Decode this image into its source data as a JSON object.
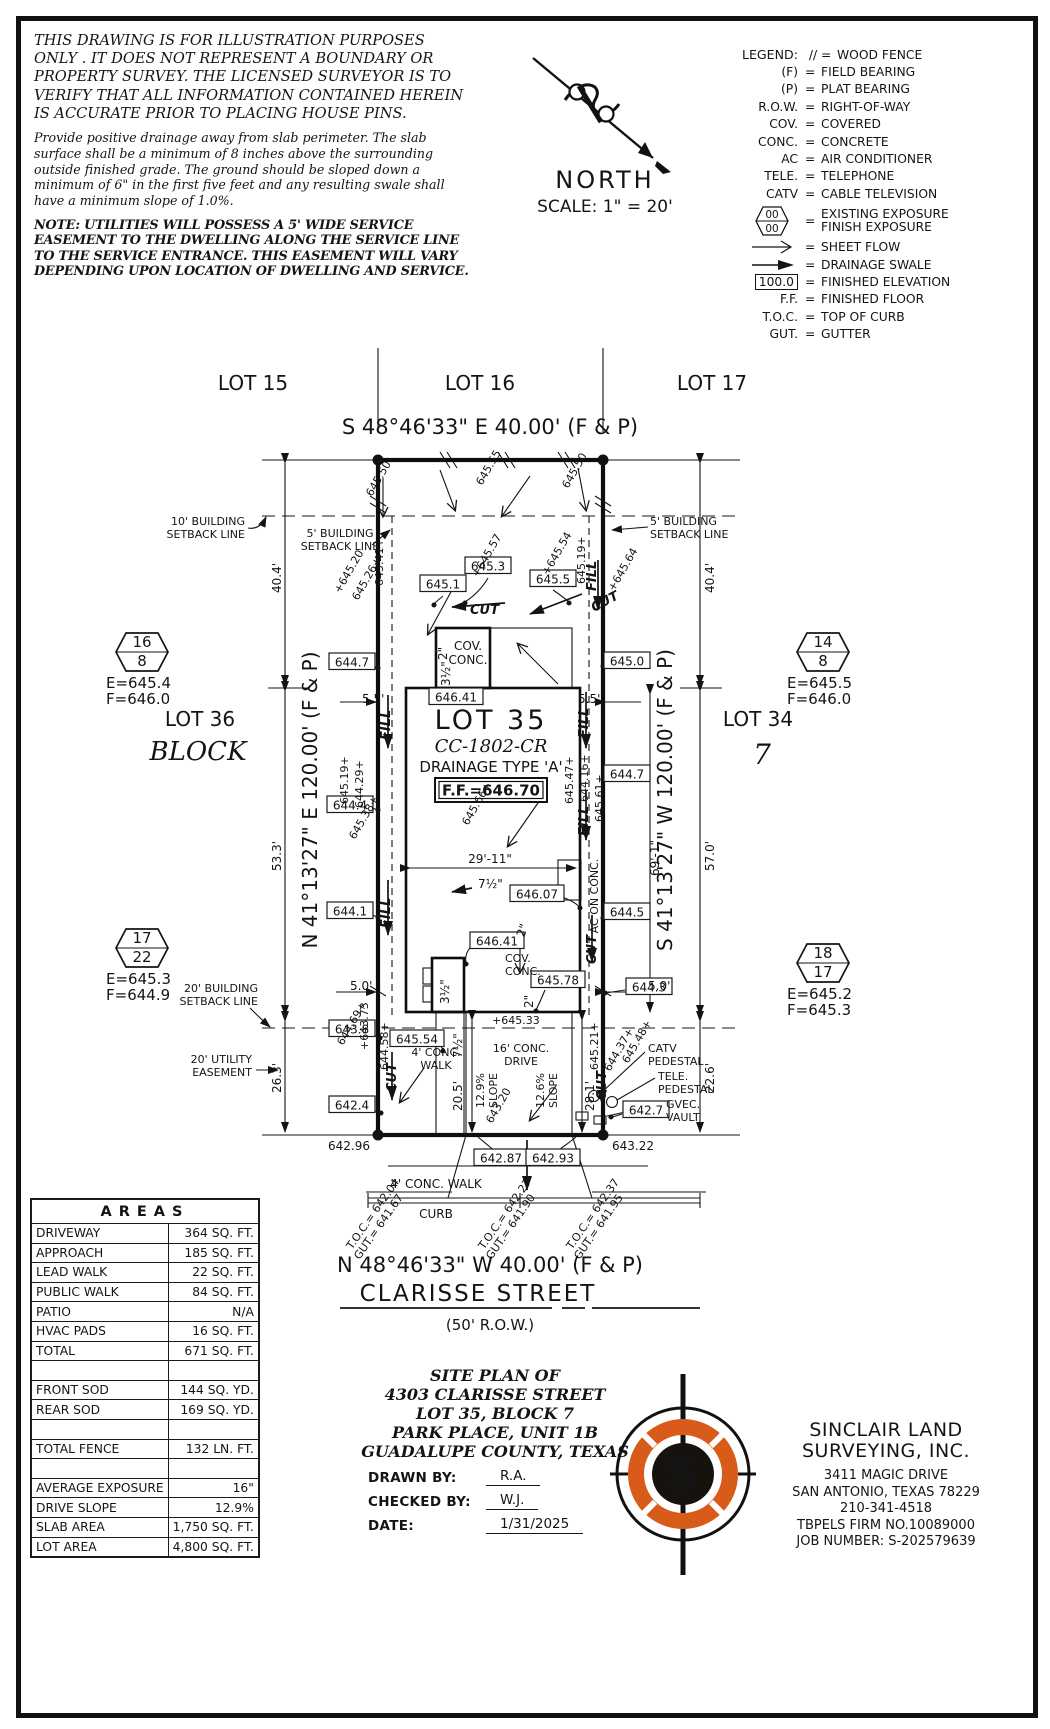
{
  "page": {
    "width": 1050,
    "height": 1729
  },
  "disclaimer": {
    "para1": "THIS DRAWING IS FOR ILLUSTRATION PURPOSES ONLY . IT DOES NOT REPRESENT A BOUNDARY OR PROPERTY SURVEY. THE LICENSED SURVEYOR IS TO VERIFY THAT ALL INFORMATION CONTAINED HEREIN IS ACCURATE PRIOR TO PLACING HOUSE PINS.",
    "para2": "Provide positive drainage away from slab perimeter. The slab surface shall be a minimum of 8 inches above the surrounding outside finished grade. The ground should be sloped down a minimum of 6\" in the first five feet and any resulting swale shall have a minimum slope of 1.0%.",
    "para3": "NOTE: UTILITIES WILL POSSESS A 5' WIDE SERVICE EASEMENT TO THE DWELLING ALONG THE SERVICE LINE TO THE SERVICE ENTRANCE. THIS EASEMENT WILL VARY DEPENDING UPON LOCATION OF DWELLING AND SERVICE."
  },
  "north": {
    "label": "NORTH",
    "scale": "SCALE: 1\" = 20'"
  },
  "legend": {
    "title": "LEGEND:",
    "eq": "=",
    "hex_top": "00",
    "hex_bottom": "00",
    "items": [
      {
        "sym": "//",
        "label": "WOOD FENCE"
      },
      {
        "sym": "(F)",
        "label": "FIELD BEARING"
      },
      {
        "sym": "(P)",
        "label": "PLAT BEARING"
      },
      {
        "sym": "R.O.W.",
        "label": "RIGHT-OF-WAY"
      },
      {
        "sym": "COV.",
        "label": "COVERED"
      },
      {
        "sym": "CONC.",
        "label": "CONCRETE"
      },
      {
        "sym": "AC",
        "label": "AIR CONDITIONER"
      },
      {
        "sym": "TELE.",
        "label": "TELEPHONE"
      },
      {
        "sym": "CATV",
        "label": "CABLE TELEVISION"
      },
      {
        "sym": "00/00",
        "label": "EXISTING EXPOSURE",
        "label2": "FINISH EXPOSURE"
      },
      {
        "sym": "arrow-open",
        "label": "SHEET FLOW"
      },
      {
        "sym": "arrow-solid",
        "label": "DRAINAGE SWALE"
      },
      {
        "sym": "100.0",
        "label": "FINISHED ELEVATION"
      },
      {
        "sym": "F.F.",
        "label": "FINISHED FLOOR"
      },
      {
        "sym": "T.O.C.",
        "label": "TOP OF CURB"
      },
      {
        "sym": "GUT.",
        "label": "GUTTER"
      }
    ]
  },
  "plan": {
    "lot15": "LOT 15",
    "lot16": "LOT 16",
    "lot17": "LOT 17",
    "brg_top": "S 48°46'33\" E 40.00' (F & P)",
    "brg_bottom": "N 48°46'33\" W 40.00' (F & P)",
    "brg_left": "N 41°13'27\" E 120.00' (F & P)",
    "brg_right": "S 41°13'27\" W 120.00' (F & P)",
    "street": "CLARISSE STREET",
    "row_width": "(50' R.O.W.)",
    "lot35": "LOT 35",
    "plan_code": "CC-1802-CR",
    "drainage": "DRAINAGE TYPE 'A'",
    "ff": "F.F.=646.70",
    "lot36": "LOT 36",
    "block_word": "BLOCK",
    "lot34": "LOT 34",
    "block_num": "7",
    "cut": "CUT",
    "fill": "FILL",
    "hex": [
      {
        "a": "16",
        "b": "8",
        "e": "E=645.4",
        "f": "F=646.0"
      },
      {
        "a": "14",
        "b": "8",
        "e": "E=645.5",
        "f": "F=646.0"
      },
      {
        "a": "17",
        "b": "22",
        "e": "E=645.3",
        "f": "F=644.9"
      },
      {
        "a": "18",
        "b": "17",
        "e": "E=645.2",
        "f": "F=645.3"
      }
    ],
    "dims": {
      "l1": "40.4'",
      "l2": "53.3'",
      "l3": "26.3'",
      "r1": "40.4'",
      "r2": "57.0'",
      "r3": "22.6'",
      "s55": "5.5'",
      "s50": "5.0'",
      "w2911": "29'-11\"",
      "d691": "69'-1\"",
      "d205": "20.5'",
      "d281": "28.1'",
      "i75": "7½\"",
      "i35": "3½\"",
      "i2": "2\""
    },
    "labels": {
      "setback10a": "10' BUILDING",
      "setback10b": "SETBACK LINE",
      "setback5a": "5' BUILDING",
      "setback5b": "SETBACK LINE",
      "setback20a": "20' BUILDING",
      "setback20b": "SETBACK LINE",
      "ease20a": "20' UTILITY",
      "ease20b": "EASEMENT",
      "cov": "COV.",
      "conc": "CONC.",
      "ac": "AC ON CONC.",
      "walk4a": "4' CONC.",
      "walk4b": "WALK",
      "walk4": "4' CONC. WALK",
      "drive16a": "16' CONC.",
      "drive16b": "DRIVE",
      "slope129": "12.9%",
      "slope126": "12.6%",
      "slope": "SLOPE",
      "curb": "CURB",
      "catv1": "CATV",
      "catv2": "PEDESTAL",
      "tele1": "TELE.",
      "tele2": "PEDESTAL",
      "gvec1": "GVEC.",
      "vault": "VAULT"
    },
    "boxed": [
      "645.3",
      "645.1",
      "645.5",
      "644.7",
      "645.0",
      "646.41",
      "644.4",
      "644.7",
      "644.1",
      "644.5",
      "646.07",
      "646.41",
      "645.78",
      "644.3",
      "643.8",
      "645.54",
      "642.4",
      "642.7",
      "642.87",
      "642.93"
    ],
    "spots": [
      "645.50",
      "645.55",
      "645.50",
      "+645.20",
      "645.26+",
      "645.41+",
      "+645.57",
      "+645.54",
      "645.19+",
      "+645.64",
      "645.19+",
      "644.29+",
      "645.38+",
      "645.66+",
      "645.47+",
      "644.16+",
      "645.61+",
      "644.69+",
      "+643.73",
      "644.58+",
      "+645.33",
      "645.21+",
      "644.37+",
      "645.48+",
      "643.20",
      "642.96",
      "643.22"
    ],
    "toc": [
      {
        "t": "T.O.C.= 642.04",
        "g": "GUT.= 641.67"
      },
      {
        "t": "T.O.C.= 642.27",
        "g": "GUT.= 641.90"
      },
      {
        "t": "T.O.C.= 642.37",
        "g": "GUT.= 641.95"
      }
    ]
  },
  "areas": {
    "title": "AREAS",
    "rows": [
      {
        "label": "DRIVEWAY",
        "value": "364 SQ. FT."
      },
      {
        "label": "APPROACH",
        "value": "185 SQ. FT."
      },
      {
        "label": "LEAD WALK",
        "value": "22 SQ. FT."
      },
      {
        "label": "PUBLIC WALK",
        "value": "84 SQ. FT."
      },
      {
        "label": "PATIO",
        "value": "N/A"
      },
      {
        "label": "HVAC PADS",
        "value": "16 SQ. FT."
      },
      {
        "label": "TOTAL",
        "value": "671 SQ. FT."
      },
      {
        "label": "",
        "value": ""
      },
      {
        "label": "FRONT SOD",
        "value": "144 SQ. YD."
      },
      {
        "label": "REAR SOD",
        "value": "169 SQ. YD."
      },
      {
        "label": "",
        "value": ""
      },
      {
        "label": "TOTAL FENCE",
        "value": "132 LN. FT."
      },
      {
        "label": "",
        "value": ""
      },
      {
        "label": "AVERAGE EXPOSURE",
        "value": "16\""
      },
      {
        "label": "DRIVE SLOPE",
        "value": "12.9%"
      },
      {
        "label": "SLAB AREA",
        "value": "1,750 SQ. FT."
      },
      {
        "label": "LOT AREA",
        "value": "4,800 SQ. FT."
      }
    ]
  },
  "titleblock": {
    "line1": "SITE PLAN OF",
    "line2": "4303 CLARISSE STREET",
    "line3": "LOT 35, BLOCK 7",
    "line4": "PARK PLACE, UNIT 1B",
    "line5": "GUADALUPE COUNTY, TEXAS",
    "drawn_label": "DRAWN BY:",
    "drawn": "R.A.",
    "checked_label": "CHECKED BY:",
    "checked": "W.J.",
    "date_label": "DATE:",
    "date": "1/31/2025"
  },
  "company": {
    "name1": "SINCLAIR LAND",
    "name2": "SURVEYING, INC.",
    "addr1": "3411 MAGIC DRIVE",
    "addr2": "SAN ANTONIO, TEXAS 78229",
    "phone": "210-341-4518",
    "firm": "TBPELS FIRM NO.10089000",
    "job": "JOB NUMBER: S-202579639",
    "logo_letter": "S"
  },
  "colors": {
    "ink": "#141414",
    "accent_orange": "#d95b1a"
  }
}
